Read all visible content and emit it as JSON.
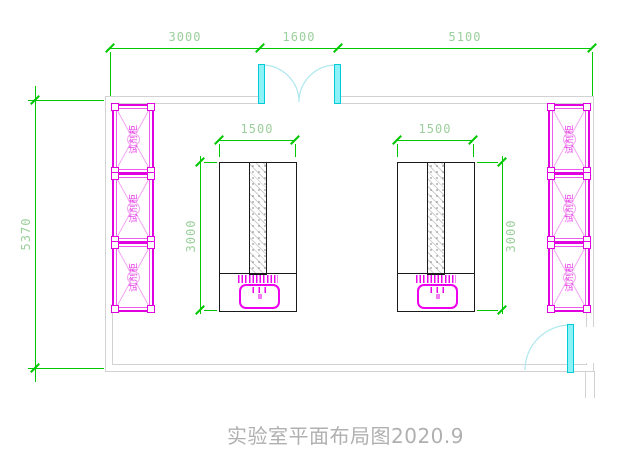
{
  "title": "实验室平面布局图2020.9",
  "dimensions": {
    "top_segments": [
      "3000",
      "1600",
      "5100"
    ],
    "room_height": "5370",
    "bench_left": {
      "width": "1500",
      "depth": "3000"
    },
    "bench_right": {
      "width": "1500",
      "depth": "3000"
    }
  },
  "cabinets": {
    "label": "试剂柜",
    "left_wall_count": 3,
    "right_wall_count": 3
  },
  "doors": {
    "top_double_door_opening": "1600",
    "side_door_count": 1
  },
  "colors": {
    "dimension_line": "#00c800",
    "dimension_text": "#9ccf9c",
    "cabinet_magenta": "#e000e0",
    "door_cyan": "#00ccd8",
    "wall_gray": "#d2d2d2",
    "bench_outline": "#1a1a1a",
    "title_gray": "#b0b0b0"
  }
}
